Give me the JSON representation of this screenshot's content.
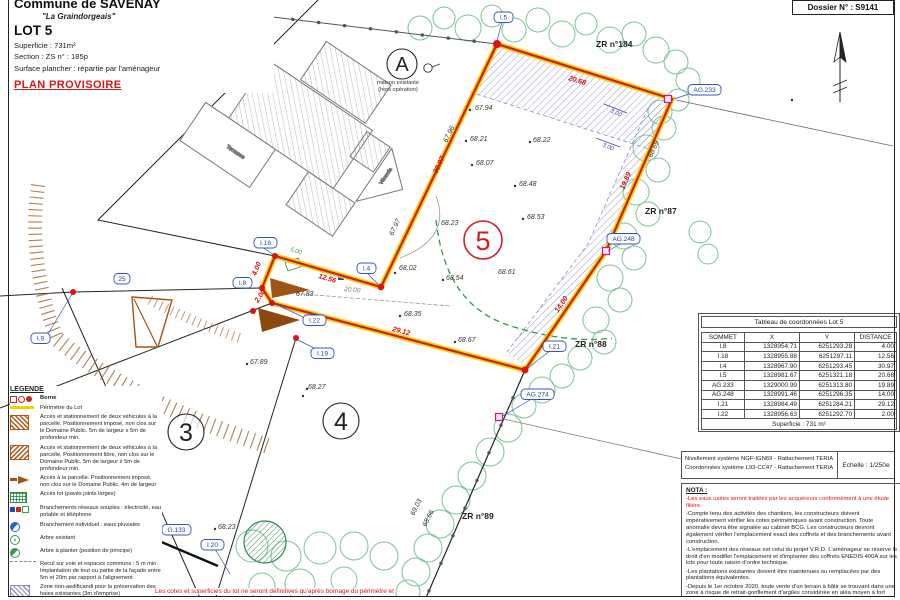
{
  "header": {
    "commune": "Commune de SAVENAY",
    "place": "\"La Graindorgeais\"",
    "lot": "LOT 5",
    "superficie": "Superficie :  731m²",
    "section": "Section :  ZS      n° :  185p",
    "surface": "Surface plancher : répartie par l'aménageur",
    "status": "PLAN PROVISOIRE"
  },
  "dossier": "Dossier N° : S9141",
  "coord_table": {
    "title": "Tableau de coordonnées Lot 5",
    "headers": [
      "SOMMET",
      "X",
      "Y",
      "DISTANCE"
    ],
    "rows": [
      [
        "I.8",
        "1328954.71",
        "6251293.28",
        "4.00"
      ],
      [
        "I.18",
        "1328955.88",
        "6251297.11",
        "12.56"
      ],
      [
        "I.4",
        "1328967.90",
        "6251293.45",
        "30.97"
      ],
      [
        "I.5",
        "1328981.67",
        "6251321.18",
        "20.68"
      ],
      [
        "AG.233",
        "1329000.99",
        "6251313.80",
        "19.89"
      ],
      [
        "AG.248",
        "1328991.46",
        "6251296.35",
        "14.00"
      ],
      [
        "I.21",
        "1328984.49",
        "6251284.21",
        "29.12"
      ],
      [
        "I.22",
        "1328956.63",
        "6251292.70",
        "2.00"
      ]
    ],
    "footer": "Superficie : 731 m²"
  },
  "survey_info": {
    "line1": "Nivellement système NGF-IGN69 - Rattachement TERIA",
    "line2": "Coordonnées système L93-CC47  - Rattachement TERIA",
    "scale": "Echelle : 1/250e"
  },
  "nota": {
    "title": "NOTA :",
    "items": [
      "-Les eaux usées seront traitées par les acquéreurs conformément à une étude filière.",
      "-Compte tenu des activités des chantiers, les constructeurs doivent impérativement vérifier les cotes périmétriques avant construction. Toute anomalie devra être signalée au cabinet BCG. Les constructeurs devront également vérifier l'emplacement exact des coffrets et des branchements avant construction.",
      "-L'emplacement des réseaux est celui du projet V.R.D. L'aménageur se réserve le droit d'en modifier l'emplacement et d'implanter des coffrets ENEDIS 400A sur les lots pour toute raison d'ordre technique.",
      "-Les plantations existantes doivent être maintenues ou remplacées par des plantations équivalentes.",
      "-Depuis le 1er octobre 2020, toute vente d'un terrain à bâtir se trouvant dans une zone à risque de retrait-gonflement d'argiles considérée en aléa moyen à fort devra être précédée d'une étude de sol particulière, à charge du vendeur.",
      "Terrain argileux :     ☐ OUI      ☒ NON"
    ]
  },
  "footer_note": "Les cotes et superficies du lot ne seront définitives qu'après bornage du périmètre et",
  "legend": {
    "title": "LEGENDE",
    "items": [
      "Borne",
      "Périmètre du Lot",
      "Accès et stationnement de deux véhicules à la parcelle. Positionnement imposé, non clos sur le Domaine Public. 5m de largeur x 5m de profondeur min.",
      "Accès et stationnement de deux véhicules à la parcelle. Positionnement libre, non clos sur le Domaine Public. 5m de largeur x 5m de profondeur min.",
      "Accès à la parcelle. Positionnement imposé, non clos sur le Domaine Public. 4m de largeur",
      "Accès lot (pavés joints larges)",
      "Branchements réseaux souples : électricité, eau potable et téléphone",
      "Branchement individuel : eaux pluviales",
      "Arbre existant",
      "Arbre à planter (position de principe)",
      "Recul sur voie et espaces communs : 5 m min. Implantation de tout ou partie de la façade entre 5m et 20m par rapport à l'alignement",
      "Zone non-aedificandi pour la préservation des haies existantes (3m d'emprise)",
      "Cote altimétrique du terrain naturel",
      "Pente et cote voirie projet"
    ],
    "cote_value": "24.56",
    "pente_pct": "2.0%",
    "pente_value": "68.95"
  },
  "map": {
    "zones": {
      "zr184": "ZR n°184",
      "zr87": "ZR n°87",
      "zr88": "ZR n°88",
      "zr89": "ZR n°89"
    },
    "lot_circles": {
      "a": "A",
      "l3": "3",
      "l4": "4",
      "l5": "5"
    },
    "house_note_1": "maison existante",
    "house_note_2": "(hors opération)",
    "terrasse": "Terrasse",
    "veranda": "Véranda",
    "points": {
      "i2": "I.2",
      "i5": "I.5",
      "i18": "I.18",
      "i8": "I.8",
      "i4": "I.4",
      "i22": "I.22",
      "i9": "I.9",
      "i19": "I.19",
      "i21": "I.21",
      "i20": "I.20",
      "g133": "G.133",
      "ag233": "AG.233",
      "ag248": "AG.248",
      "ag274": "AG.274",
      "n25": "25"
    },
    "dimensions": {
      "d400": "4.00",
      "d1256": "12.56",
      "d3097": "30.97",
      "d2068": "20.68",
      "d1989": "19.89",
      "d1400": "14.00",
      "d2912": "29.12",
      "d200": "2.00",
      "d2000": "20.00",
      "d500": "5.00",
      "d300a": "3.00",
      "d300b": "3.00"
    },
    "elevations": {
      "e1": "67.94",
      "e2": "68.21",
      "e3": "68.22",
      "e4": "68.07",
      "e5": "68.48",
      "e6": "68.53",
      "e7": "68.23",
      "e8": "68.02",
      "e9": "68.54",
      "e10": "68.61",
      "e11": "67.83",
      "e12": "68.35",
      "e13": "68.67",
      "e14": "67.89",
      "e15": "68.27",
      "e16": "68.23",
      "e17": "67.96",
      "e18": "67.97",
      "e19": "68.69",
      "e20": "69.03",
      "e21": "68.66"
    }
  },
  "colors": {
    "boundary_red": "#cf1f1f",
    "perimeter_yellow": "#f2cf00",
    "label_blue": "#3355bb",
    "tree_green": "#7cc397",
    "hatch_purple": "#9090cc",
    "access_brown": "#a05515",
    "note_red": "#d81414"
  }
}
